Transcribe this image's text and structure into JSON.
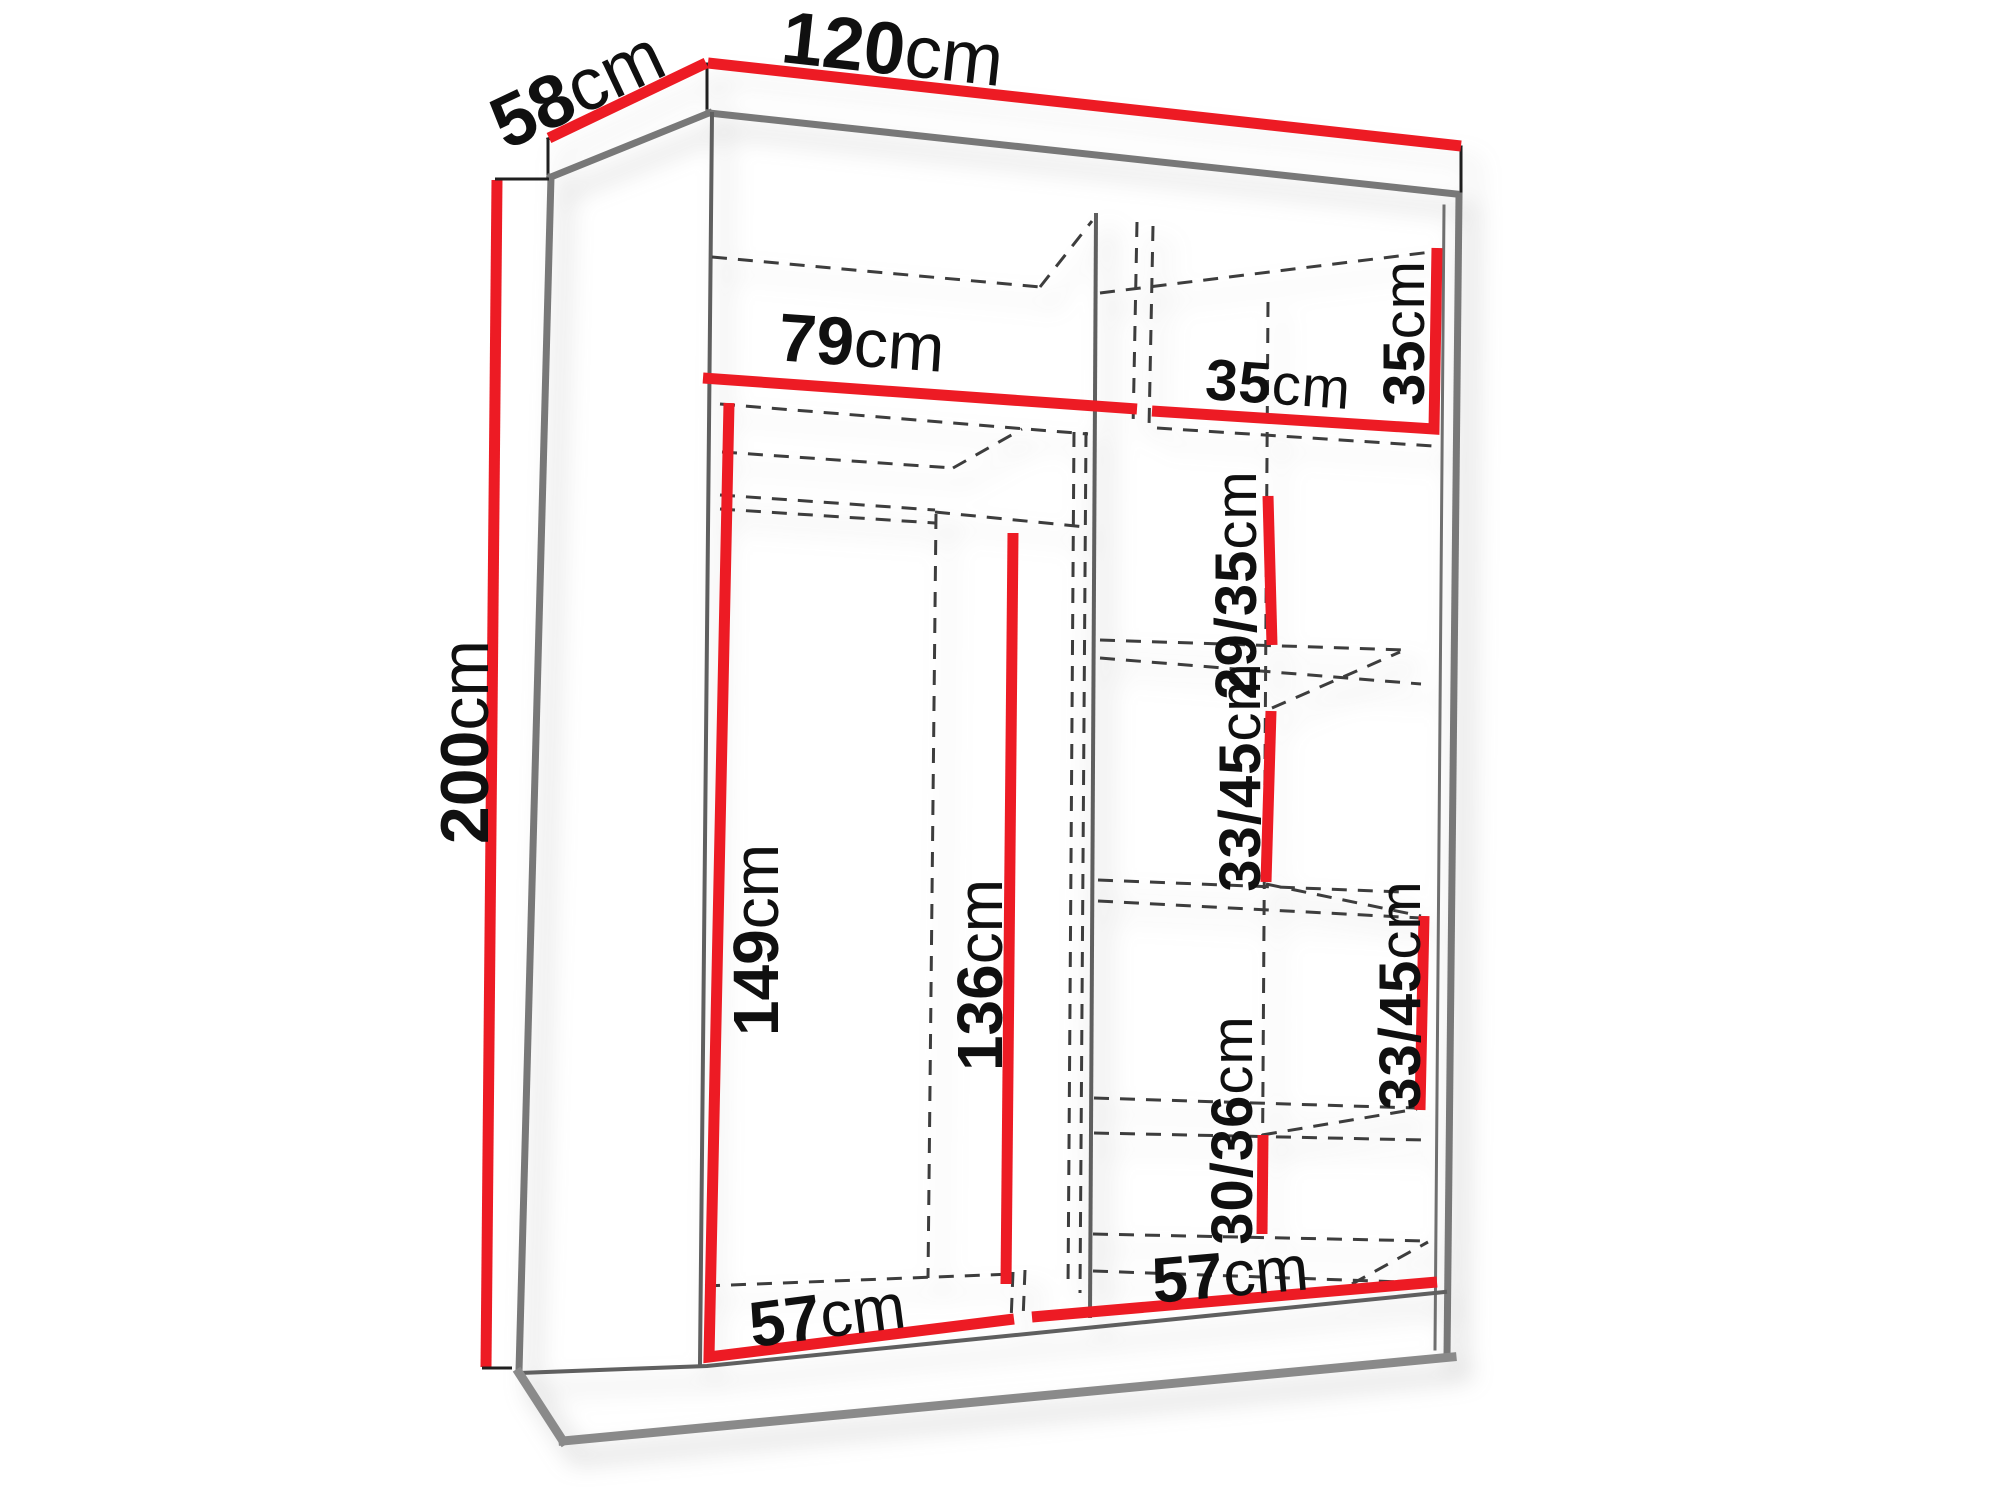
{
  "diagram": {
    "type": "furniture-dimension-diagram",
    "subject": "two-door sliding wardrobe, 3/4 line view with interior shelf layout",
    "colors": {
      "dimension_red": "#ed1b24",
      "outline_gray": "#787878",
      "line_black": "#1f1f1f",
      "dashed_gray": "#3d3d3d",
      "background": "#ffffff"
    },
    "labels": {
      "width_total": {
        "value": "120",
        "unit": "cm"
      },
      "depth_total": {
        "value": "58",
        "unit": "cm"
      },
      "height_total": {
        "value": "200",
        "unit": "cm"
      },
      "top_left_width": {
        "value": "79",
        "unit": "cm"
      },
      "top_right_width": {
        "value": "35",
        "unit": "cm"
      },
      "top_right_height": {
        "value": "35",
        "unit": "cm"
      },
      "shelf_gap_1": {
        "value": "29/35",
        "unit": "cm"
      },
      "shelf_gap_2": {
        "value": "33/45",
        "unit": "cm"
      },
      "shelf_gap_3": {
        "value": "33/45",
        "unit": "cm"
      },
      "shelf_gap_4": {
        "value": "30/36",
        "unit": "cm"
      },
      "hanging_height": {
        "value": "149",
        "unit": "cm"
      },
      "inner_height": {
        "value": "136",
        "unit": "cm"
      },
      "left_floor_width": {
        "value": "57",
        "unit": "cm"
      },
      "right_floor_width": {
        "value": "57",
        "unit": "cm"
      }
    }
  }
}
